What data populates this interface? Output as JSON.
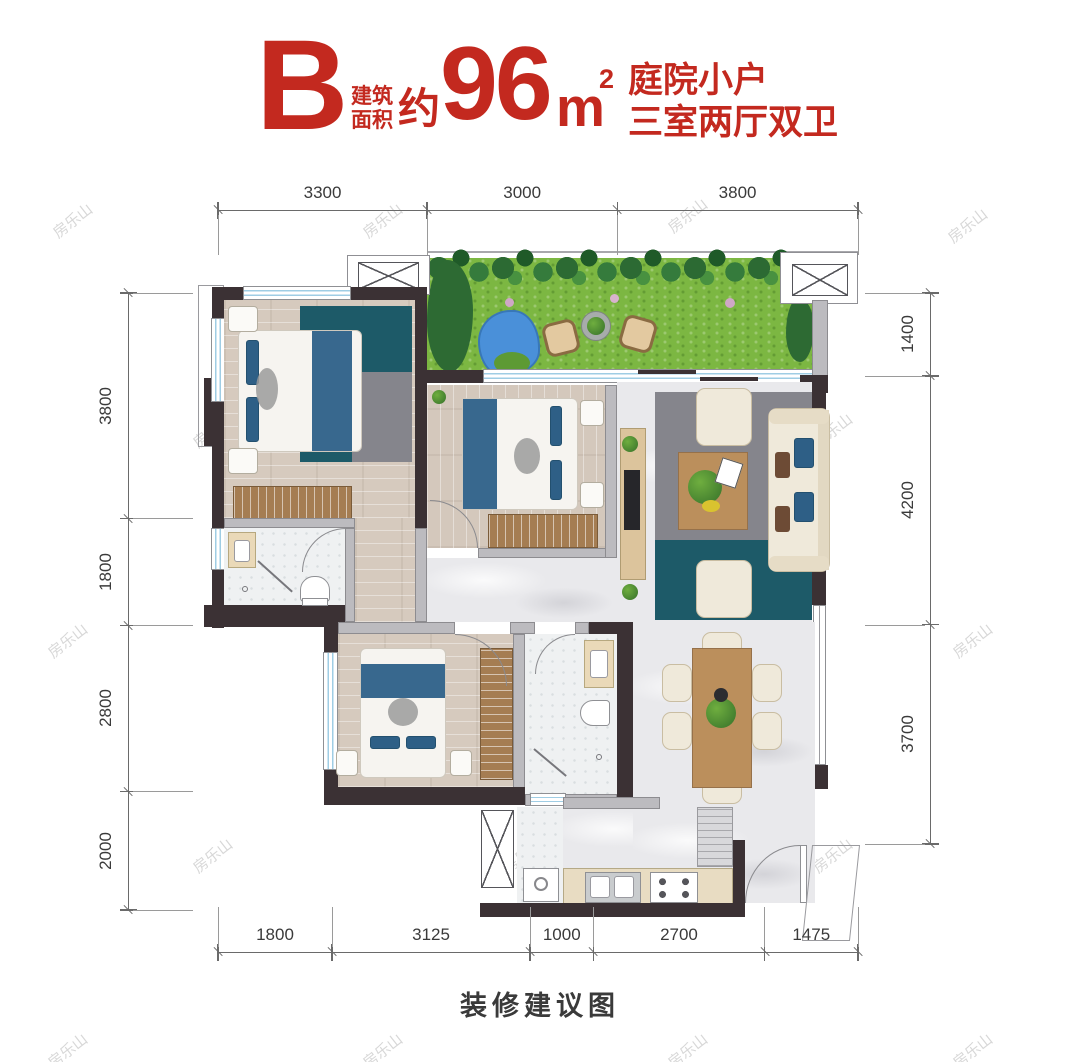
{
  "header": {
    "unit_letter": "B",
    "area_label_line1": "建筑",
    "area_label_line2": "面积",
    "area_approx": "约",
    "area_value": "96",
    "area_unit": "m",
    "area_sup": "2",
    "tagline_line1": "庭院小户",
    "tagline_line2": "三室两厅双卫",
    "accent_color": "#c3291f"
  },
  "dimensions": {
    "top": [
      "3300",
      "3000",
      "3800"
    ],
    "bottom": [
      "1800",
      "3125",
      "1000",
      "2700",
      "1475"
    ],
    "left": [
      "3800",
      "1800",
      "2800",
      "2000"
    ],
    "right": [
      "1400",
      "4200",
      "3700"
    ]
  },
  "caption": "装修建议图",
  "watermark": {
    "text": "房乐山"
  }
}
